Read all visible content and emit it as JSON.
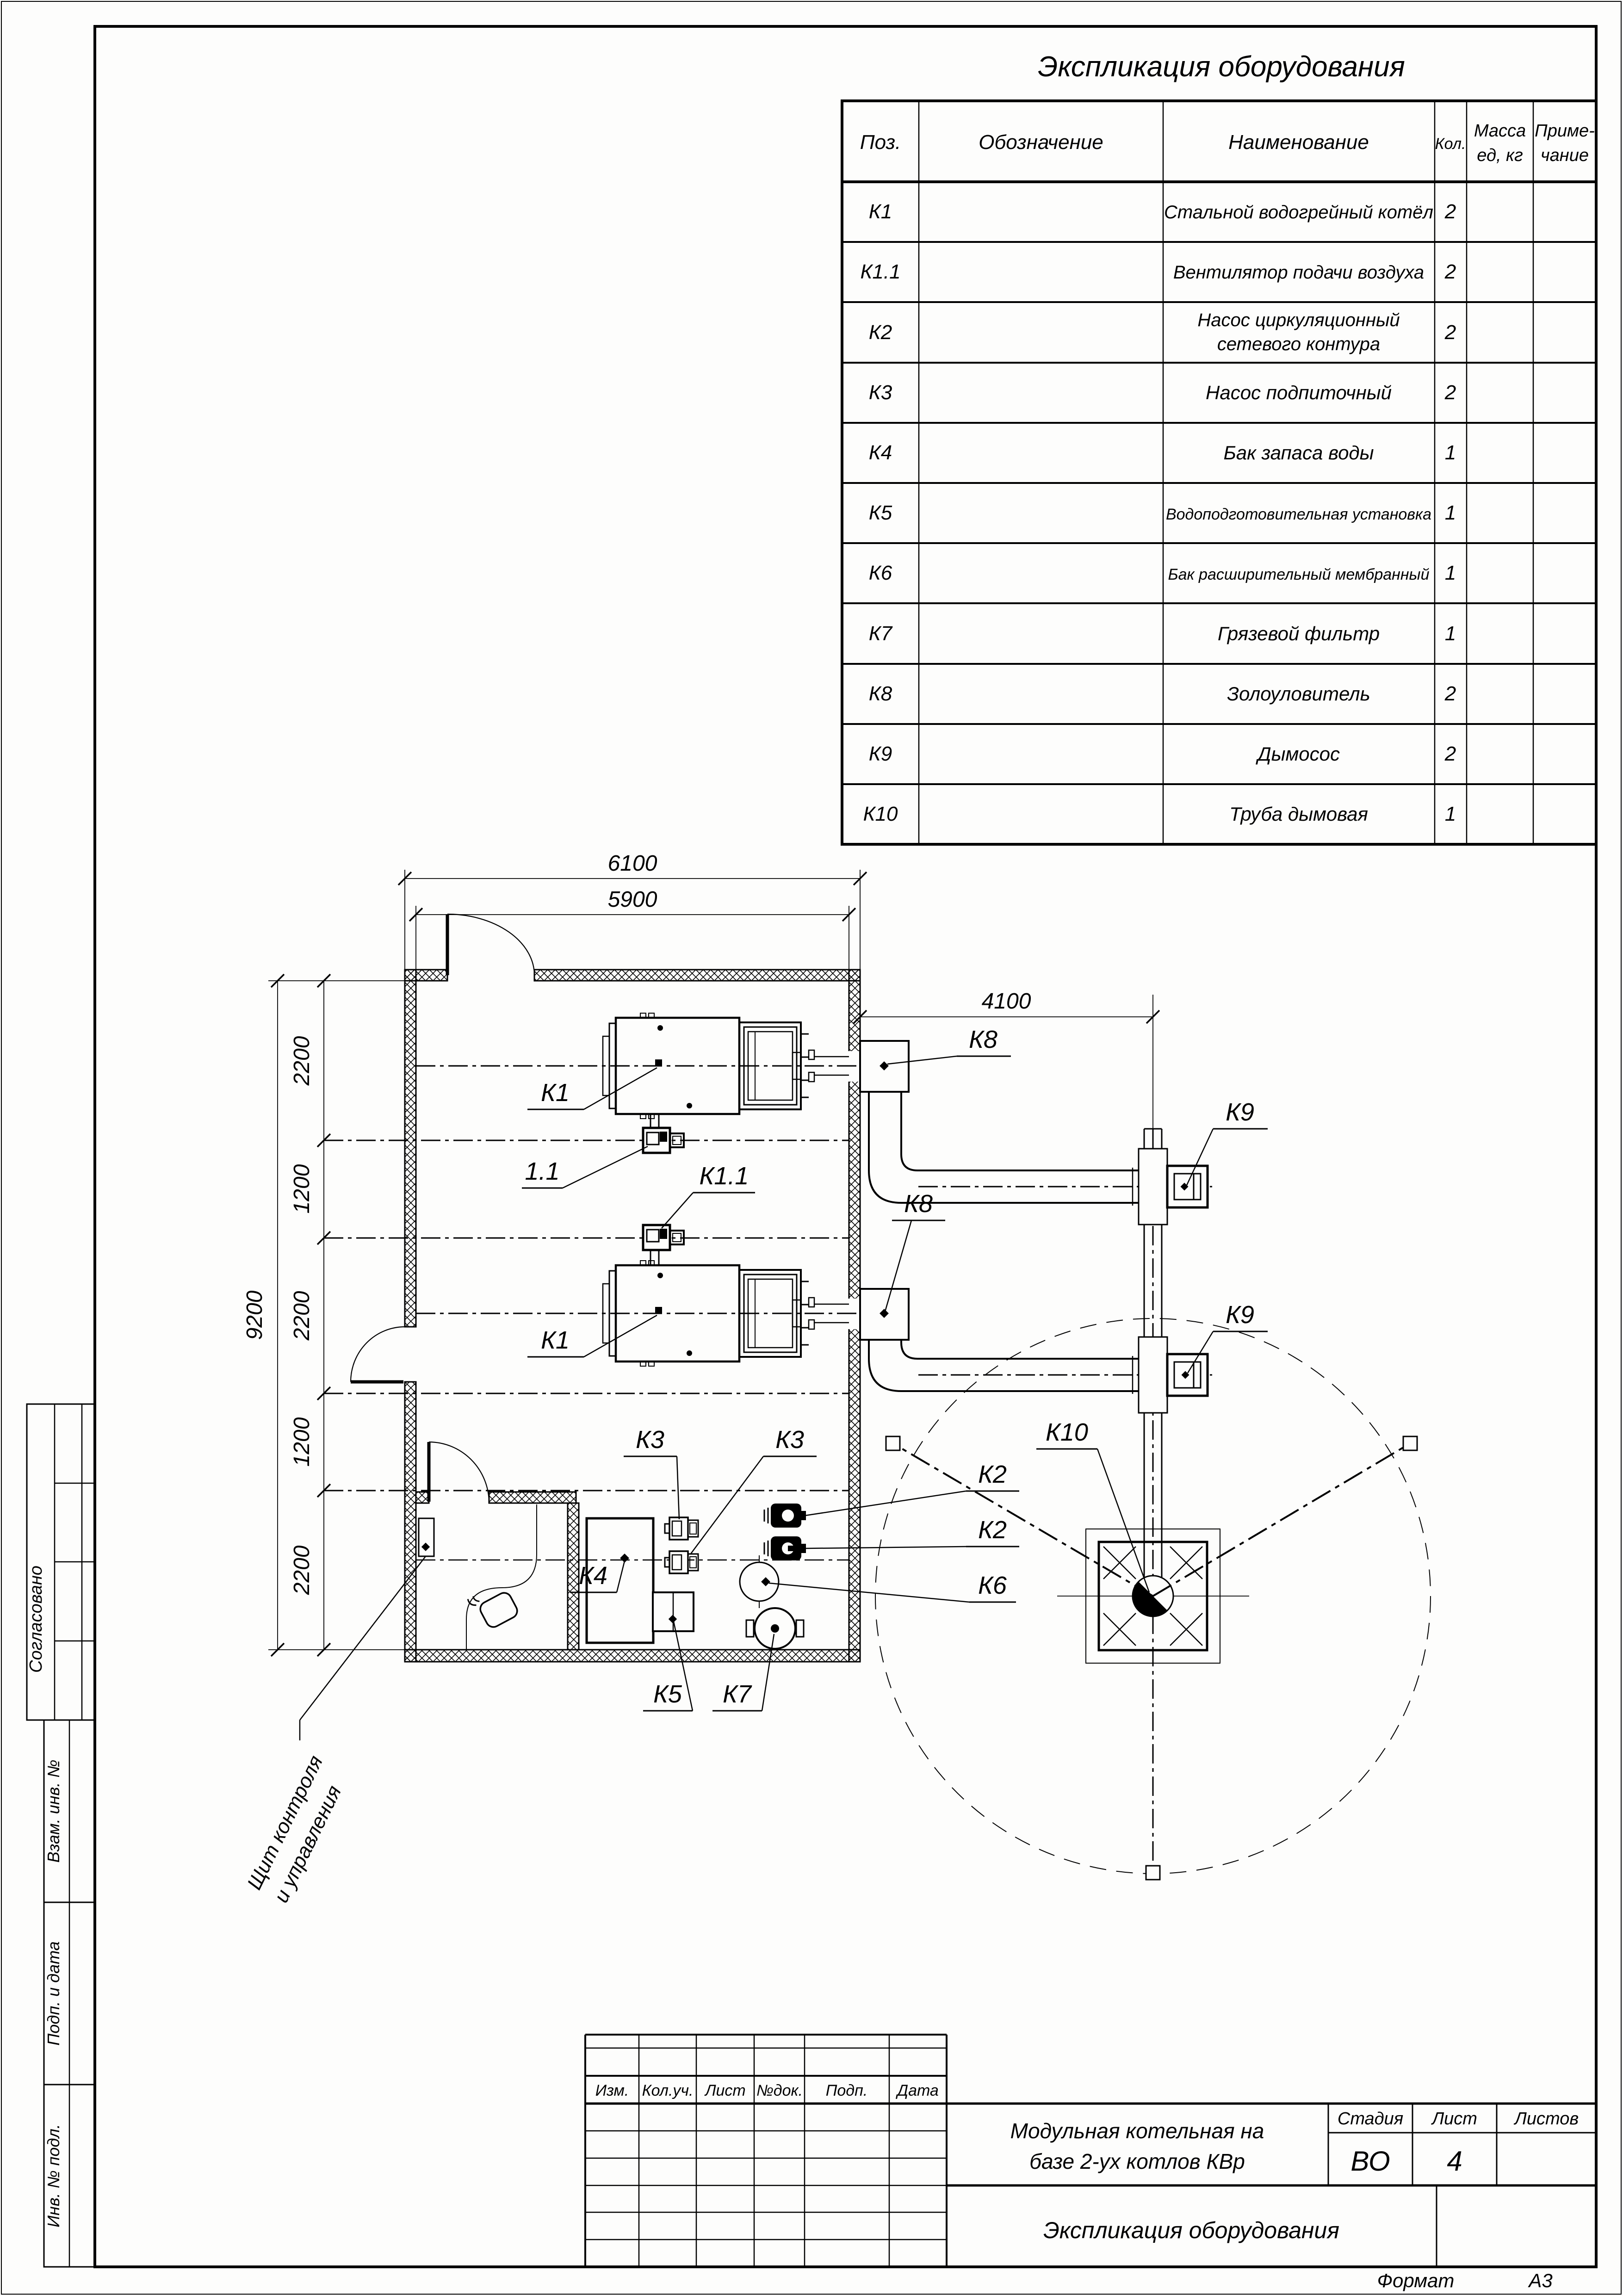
{
  "sheet": {
    "format_label": "Формат",
    "format_value": "А3"
  },
  "equipment_table": {
    "title": "Экспликация оборудования",
    "col_pos": "Поз.",
    "col_designation": "Обозначение",
    "col_name": "Наименование",
    "col_qty": "Кол.",
    "col_mass_1": "Масса",
    "col_mass_2": "ед, кг",
    "col_note_1": "Приме-",
    "col_note_2": "чание",
    "rows": [
      {
        "pos": "К1",
        "name": "Стальной водогрейный котёл",
        "qty": "2"
      },
      {
        "pos": "К1.1",
        "name": "Вентилятор подачи воздуха",
        "qty": "2"
      },
      {
        "pos": "К2",
        "name": "Насос циркуляционный",
        "name2": "сетевого контура",
        "qty": "2"
      },
      {
        "pos": "К3",
        "name": "Насос подпиточный",
        "qty": "2"
      },
      {
        "pos": "К4",
        "name": "Бак запаса воды",
        "qty": "1"
      },
      {
        "pos": "К5",
        "name": "Водоподготовительная установка",
        "qty": "1"
      },
      {
        "pos": "К6",
        "name": "Бак расширительный мембранный",
        "qty": "1"
      },
      {
        "pos": "К7",
        "name": "Грязевой фильтр",
        "qty": "1"
      },
      {
        "pos": "К8",
        "name": "Золоуловитель",
        "qty": "2"
      },
      {
        "pos": "К9",
        "name": "Дымосос",
        "qty": "2"
      },
      {
        "pos": "К10",
        "name": "Труба дымовая",
        "qty": "1"
      }
    ]
  },
  "plan": {
    "dim_6100": "6100",
    "dim_5900": "5900",
    "dim_4100": "4100",
    "dim_9200": "9200",
    "seg_1": "2200",
    "seg_2": "1200",
    "seg_3": "2200",
    "seg_4": "1200",
    "seg_5": "2200",
    "lbl_k1_a": "К1",
    "lbl_k1_b": "К1",
    "lbl_11": "1.1",
    "lbl_k11": "К1.1",
    "lbl_k8_a": "К8",
    "lbl_k8_b": "К8",
    "lbl_k9_a": "К9",
    "lbl_k9_b": "К9",
    "lbl_k10": "К10",
    "lbl_k2_a": "К2",
    "lbl_k2_b": "К2",
    "lbl_k3_a": "К3",
    "lbl_k3_b": "К3",
    "lbl_k4": "К4",
    "lbl_k5": "К5",
    "lbl_k6": "К6",
    "lbl_k7": "К7",
    "note_panel_1": "Щит контроля",
    "note_panel_2": "и управления"
  },
  "title_block": {
    "project_1": "Модульная котельная на",
    "project_2": "базе 2-ух котлов КВр",
    "doc_title": "Экспликация оборудования",
    "stage_label": "Стадия",
    "sheet_label": "Лист",
    "sheets_label": "Листов",
    "stage_value": "ВО",
    "sheet_value": "4",
    "rev_izm": "Изм.",
    "rev_koluch": "Кол.уч.",
    "rev_list": "Лист",
    "rev_ndok": "№док.",
    "rev_podp": "Подп.",
    "rev_data": "Дата"
  },
  "side_stamp": {
    "agreed": "Согласовано",
    "vzam": "Взам. инв. №",
    "podp_data": "Подп. и дата",
    "inv_podl": "Инв. № подл."
  }
}
